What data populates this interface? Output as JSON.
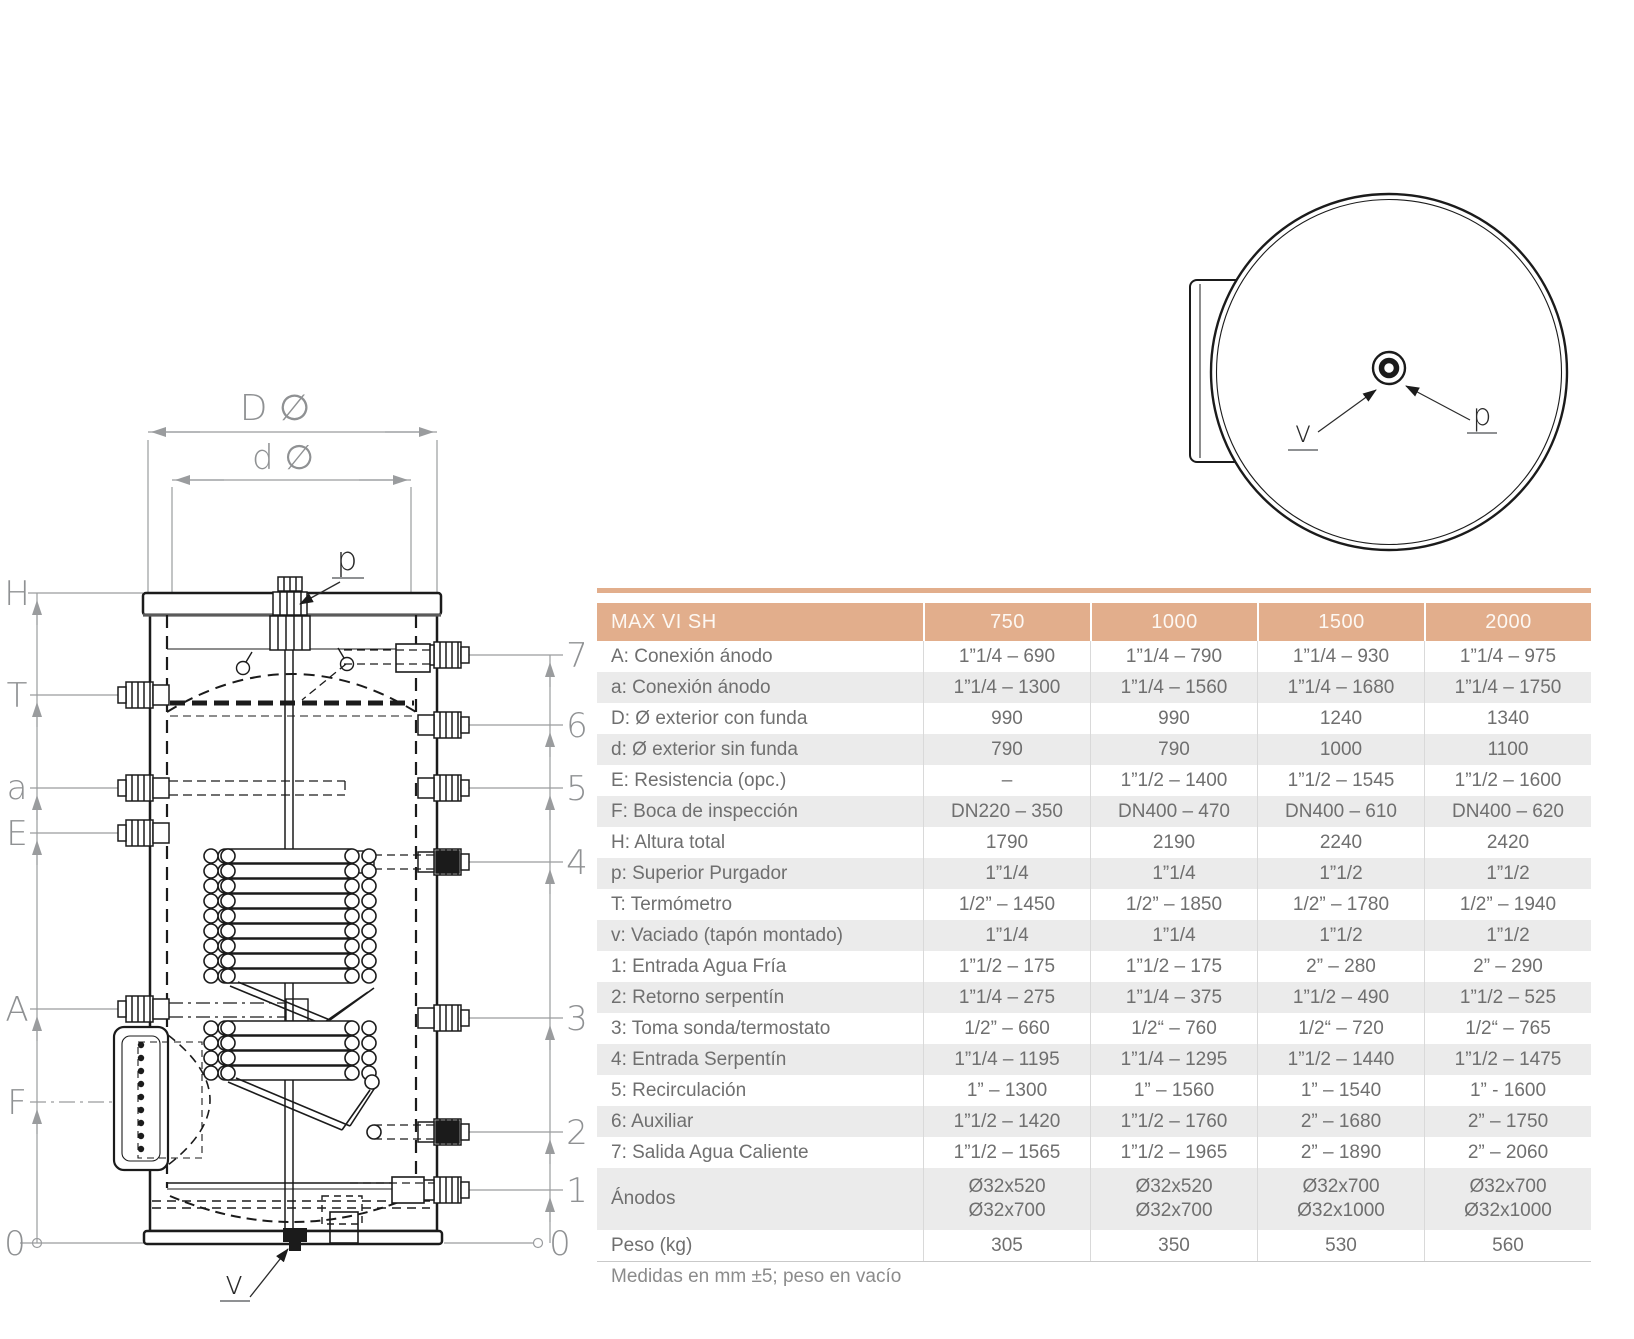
{
  "colors": {
    "header_bg": "#e2ae8c",
    "header_text": "#fdf8f3",
    "row_alt_bg": "#ebebeb",
    "body_text": "#6f6f6f",
    "note_text": "#8b8b8b",
    "dim_line": "#9a9c9e",
    "dim_text": "#8f9193",
    "drawing_line": "#1b1b1b"
  },
  "table": {
    "title": "MAX VI SH",
    "columns": [
      "750",
      "1000",
      "1500",
      "2000"
    ],
    "rows": [
      {
        "label": "A: Conexión ánodo",
        "values": [
          "1”1/4 – 690",
          "1”1/4 – 790",
          "1”1/4 – 930",
          "1”1/4 – 975"
        ]
      },
      {
        "label": "a: Conexión ánodo",
        "values": [
          "1”1/4 – 1300",
          "1”1/4 – 1560",
          "1”1/4 – 1680",
          "1”1/4 – 1750"
        ]
      },
      {
        "label": "D: Ø exterior con funda",
        "values": [
          "990",
          "990",
          "1240",
          "1340"
        ]
      },
      {
        "label": "d: Ø exterior sin funda",
        "values": [
          "790",
          "790",
          "1000",
          "1100"
        ]
      },
      {
        "label": "E: Resistencia (opc.)",
        "values": [
          "–",
          "1”1/2 – 1400",
          "1”1/2 – 1545",
          "1”1/2 – 1600"
        ]
      },
      {
        "label": "F: Boca de inspección",
        "values": [
          "DN220 – 350",
          "DN400 – 470",
          "DN400 – 610",
          "DN400 – 620"
        ]
      },
      {
        "label": "H: Altura total",
        "values": [
          "1790",
          "2190",
          "2240",
          "2420"
        ]
      },
      {
        "label": "p: Superior Purgador",
        "values": [
          "1”1/4",
          "1”1/4",
          "1”1/2",
          "1”1/2"
        ]
      },
      {
        "label": "T: Termómetro",
        "values": [
          "1/2” – 1450",
          "1/2” – 1850",
          "1/2” – 1780",
          "1/2” – 1940"
        ]
      },
      {
        "label": "v: Vaciado (tapón montado)",
        "values": [
          "1”1/4",
          "1”1/4",
          "1”1/2",
          "1”1/2"
        ]
      },
      {
        "label": "1: Entrada Agua Fría",
        "values": [
          "1”1/2 – 175",
          "1”1/2 – 175",
          "2” – 280",
          "2” – 290"
        ]
      },
      {
        "label": "2: Retorno serpentín",
        "values": [
          "1”1/4 – 275",
          "1”1/4 – 375",
          "1”1/2 – 490",
          "1”1/2 – 525"
        ]
      },
      {
        "label": "3: Toma sonda/termostato",
        "values": [
          "1/2” – 660",
          "1/2“ – 760",
          "1/2“ – 720",
          "1/2“ – 765"
        ]
      },
      {
        "label": "4: Entrada Serpentín",
        "values": [
          "1”1/4 – 1195",
          "1”1/4 – 1295",
          "1”1/2 – 1440",
          "1”1/2 – 1475"
        ]
      },
      {
        "label": "5: Recirculación",
        "values": [
          "1” – 1300",
          "1” – 1560",
          "1” – 1540",
          "1” - 1600"
        ]
      },
      {
        "label": "6: Auxiliar",
        "values": [
          "1”1/2 – 1420",
          "1”1/2 – 1760",
          "2” – 1680",
          "2” – 1750"
        ]
      },
      {
        "label": "7: Salida Agua Caliente",
        "values": [
          "1”1/2 – 1565",
          "1”1/2 – 1965",
          "2” – 1890",
          "2” – 2060"
        ]
      },
      {
        "label": "Ánodos",
        "tall": true,
        "values": [
          "Ø32x520\nØ32x700",
          "Ø32x520\nØ32x700",
          "Ø32x700\nØ32x1000",
          "Ø32x700\nØ32x1000"
        ]
      },
      {
        "label": "Peso (kg)",
        "values": [
          "305",
          "350",
          "530",
          "560"
        ]
      }
    ],
    "note": "Medidas en mm ±5; peso en vacío"
  },
  "front_view": {
    "dim_outer_diameter": "D ∅",
    "dim_inner_diameter": "d ∅",
    "label_p": "p",
    "label_v": "v",
    "left_labels": [
      "H",
      "T",
      "a",
      "E",
      "A",
      "F",
      "0"
    ],
    "right_labels": [
      "7",
      "6",
      "5",
      "4",
      "3",
      "2",
      "1",
      "0"
    ]
  },
  "top_view": {
    "label_v": "v",
    "label_p": "p"
  }
}
